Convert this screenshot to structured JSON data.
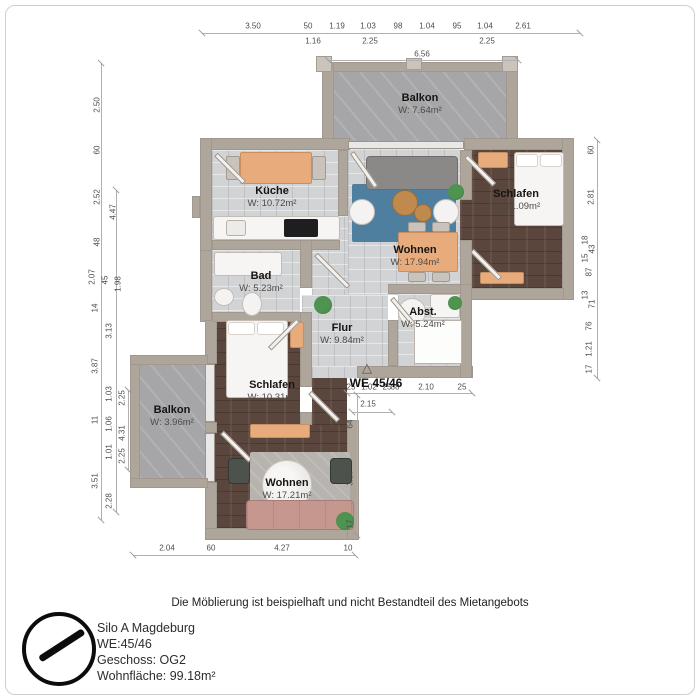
{
  "unit_label": "WE 45/46",
  "rooms": [
    {
      "name": "Balkon",
      "area": "W: 7.64m²"
    },
    {
      "name": "Küche",
      "area": "W: 10.72m²"
    },
    {
      "name": "Wohnen",
      "area": "W: 17.94m²"
    },
    {
      "name": "Schlafen",
      "area": "W: 11.09m²"
    },
    {
      "name": "Bad",
      "area": "W: 5.23m²"
    },
    {
      "name": "Flur",
      "area": "W: 9.84m²"
    },
    {
      "name": "Abst.",
      "area": "W: 5.24m²"
    },
    {
      "name": "Schlafen",
      "area": "W: 10.31m²"
    },
    {
      "name": "Balkon",
      "area": "W: 3.96m²"
    },
    {
      "name": "Wohnen",
      "area": "W: 17.21m²"
    }
  ],
  "dims": {
    "top1": [
      "3.50",
      "50",
      "1.19",
      "1.03",
      "98",
      "1.04",
      "95",
      "1.04",
      "2.61"
    ],
    "top2": [
      "1.16",
      "2.25",
      "2.25"
    ],
    "top3": [
      "6.56"
    ],
    "left": [
      "2.50",
      "60",
      "2.52",
      "4.47",
      "48",
      "2.07",
      "45",
      "1.98",
      "14",
      "3.13",
      "3.87",
      "1.03",
      "2.25",
      "11",
      "1.06",
      "4.31",
      "1.01",
      "2.25",
      "3.51",
      "2.28"
    ],
    "right": [
      "60",
      "2.81",
      "18",
      "43",
      "15",
      "87",
      "13",
      "71",
      "76",
      "1.21",
      "17"
    ],
    "we1": [
      "25",
      "1.02",
      "25",
      "88",
      "2.10",
      "25"
    ],
    "we2": [
      "2.15"
    ],
    "inner": [
      "64",
      "3.37",
      "17"
    ],
    "bottom": [
      "2.04",
      "60",
      "4.27",
      "10"
    ]
  },
  "footer": {
    "disclaimer": "Die Möblierung ist beispielhaft und nicht Bestandteil des Mietangebots",
    "project_name": "Silo A Magdeburg",
    "unit": "WE:45/46",
    "floor": "Geschoss: OG2",
    "living_area": "Wohnfläche: 99.18m²"
  },
  "colors": {
    "wall": "#aea59b",
    "tile_floor": "#d2d3d5",
    "wood_floor": "#5a463c",
    "balcony_floor": "#a6a6a8",
    "rug_blue": "#4e7f9e",
    "furniture_orange": "#e7ab7c",
    "sofa_pink": "#c6978e"
  }
}
